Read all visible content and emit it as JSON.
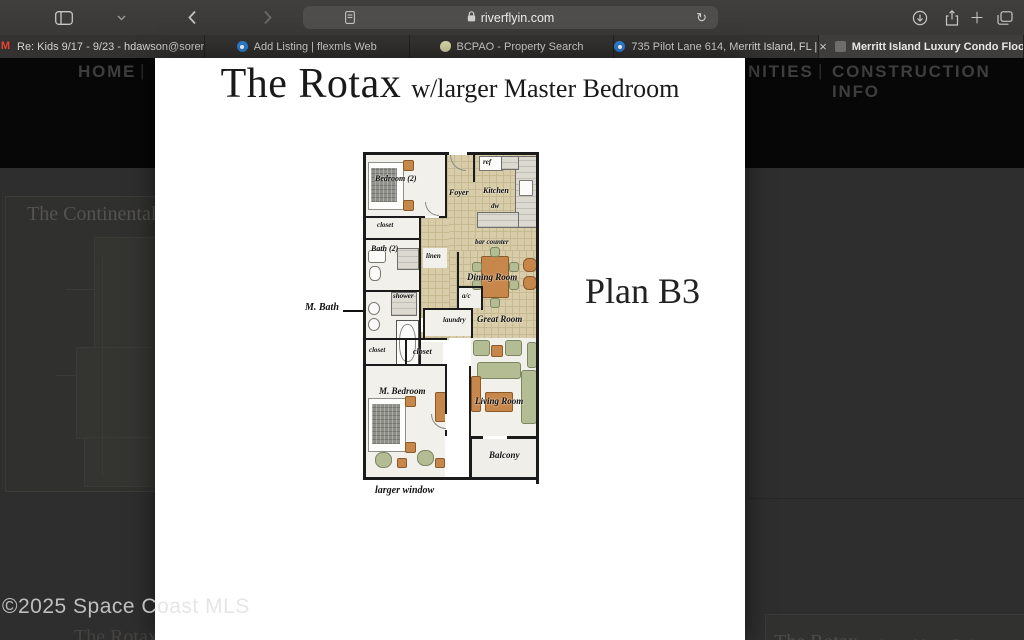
{
  "browser": {
    "url": "riverflyin.com",
    "close_glyph": "×",
    "new_tab_glyph": "＋",
    "refresh_glyph": "↻",
    "gmail_glyph": "M",
    "tabs": [
      {
        "title": "Re: Kids 9/17 - 9/23 - hdawson@sorense...",
        "icon": "gmail-icon",
        "active": false
      },
      {
        "title": "Add Listing | flexmls Web",
        "icon": "flexmls-pin-icon",
        "active": false
      },
      {
        "title": "BCPAO - Property Search",
        "icon": "bcpao-icon",
        "active": false
      },
      {
        "title": "735 Pilot Lane 614, Merritt Island, FL | M...",
        "icon": "flexmls-pin-icon",
        "active": false
      },
      {
        "title": "Merritt Island Luxury Condo Floorplans -...",
        "icon": "site-favicon",
        "active": true
      }
    ]
  },
  "site": {
    "nav": {
      "home": "HOME",
      "sep": "|",
      "right_fragment": "NITIES",
      "construction": "CONSTRUCTION INFO"
    },
    "watermark": "©2025 Space Coast MLS",
    "background": {
      "continental_title": "The Continental",
      "bottom_left_partial": "The Rotax",
      "bottom_right_title": "The Rotax",
      "bottom_right_subtitle": "w/ larger Master Bedroom"
    }
  },
  "lightbox": {
    "title": "The Rotax",
    "subtitle": "w/larger Master Bedroom",
    "plan_label": "Plan B3",
    "floorplan": {
      "bedroom2": "Bedroom (2)",
      "closet_top": "closet",
      "bath2": "Bath (2)",
      "foyer": "Foyer",
      "kitchen": "Kitchen",
      "ref": "ref",
      "dw": "dw",
      "bar_counter": "bar counter",
      "linen": "linen",
      "shower": "shower",
      "ac": "a/c",
      "laundry": "laundry",
      "dining": "Dining Room",
      "great": "Great Room",
      "closet_left": "closet",
      "closet_mid": "closet",
      "m_bath": "M. Bath",
      "m_bedroom": "M. Bedroom",
      "living": "Living Room",
      "balcony": "Balcony",
      "larger_window": "larger window"
    },
    "palette": {
      "tile": "#d8cda8",
      "tile_grid": "#c6ba92",
      "wall": "#1b1b1b",
      "furniture_orange": "#c8874a",
      "furniture_green": "#b3bc93",
      "floor": "#f1f0ea"
    }
  }
}
